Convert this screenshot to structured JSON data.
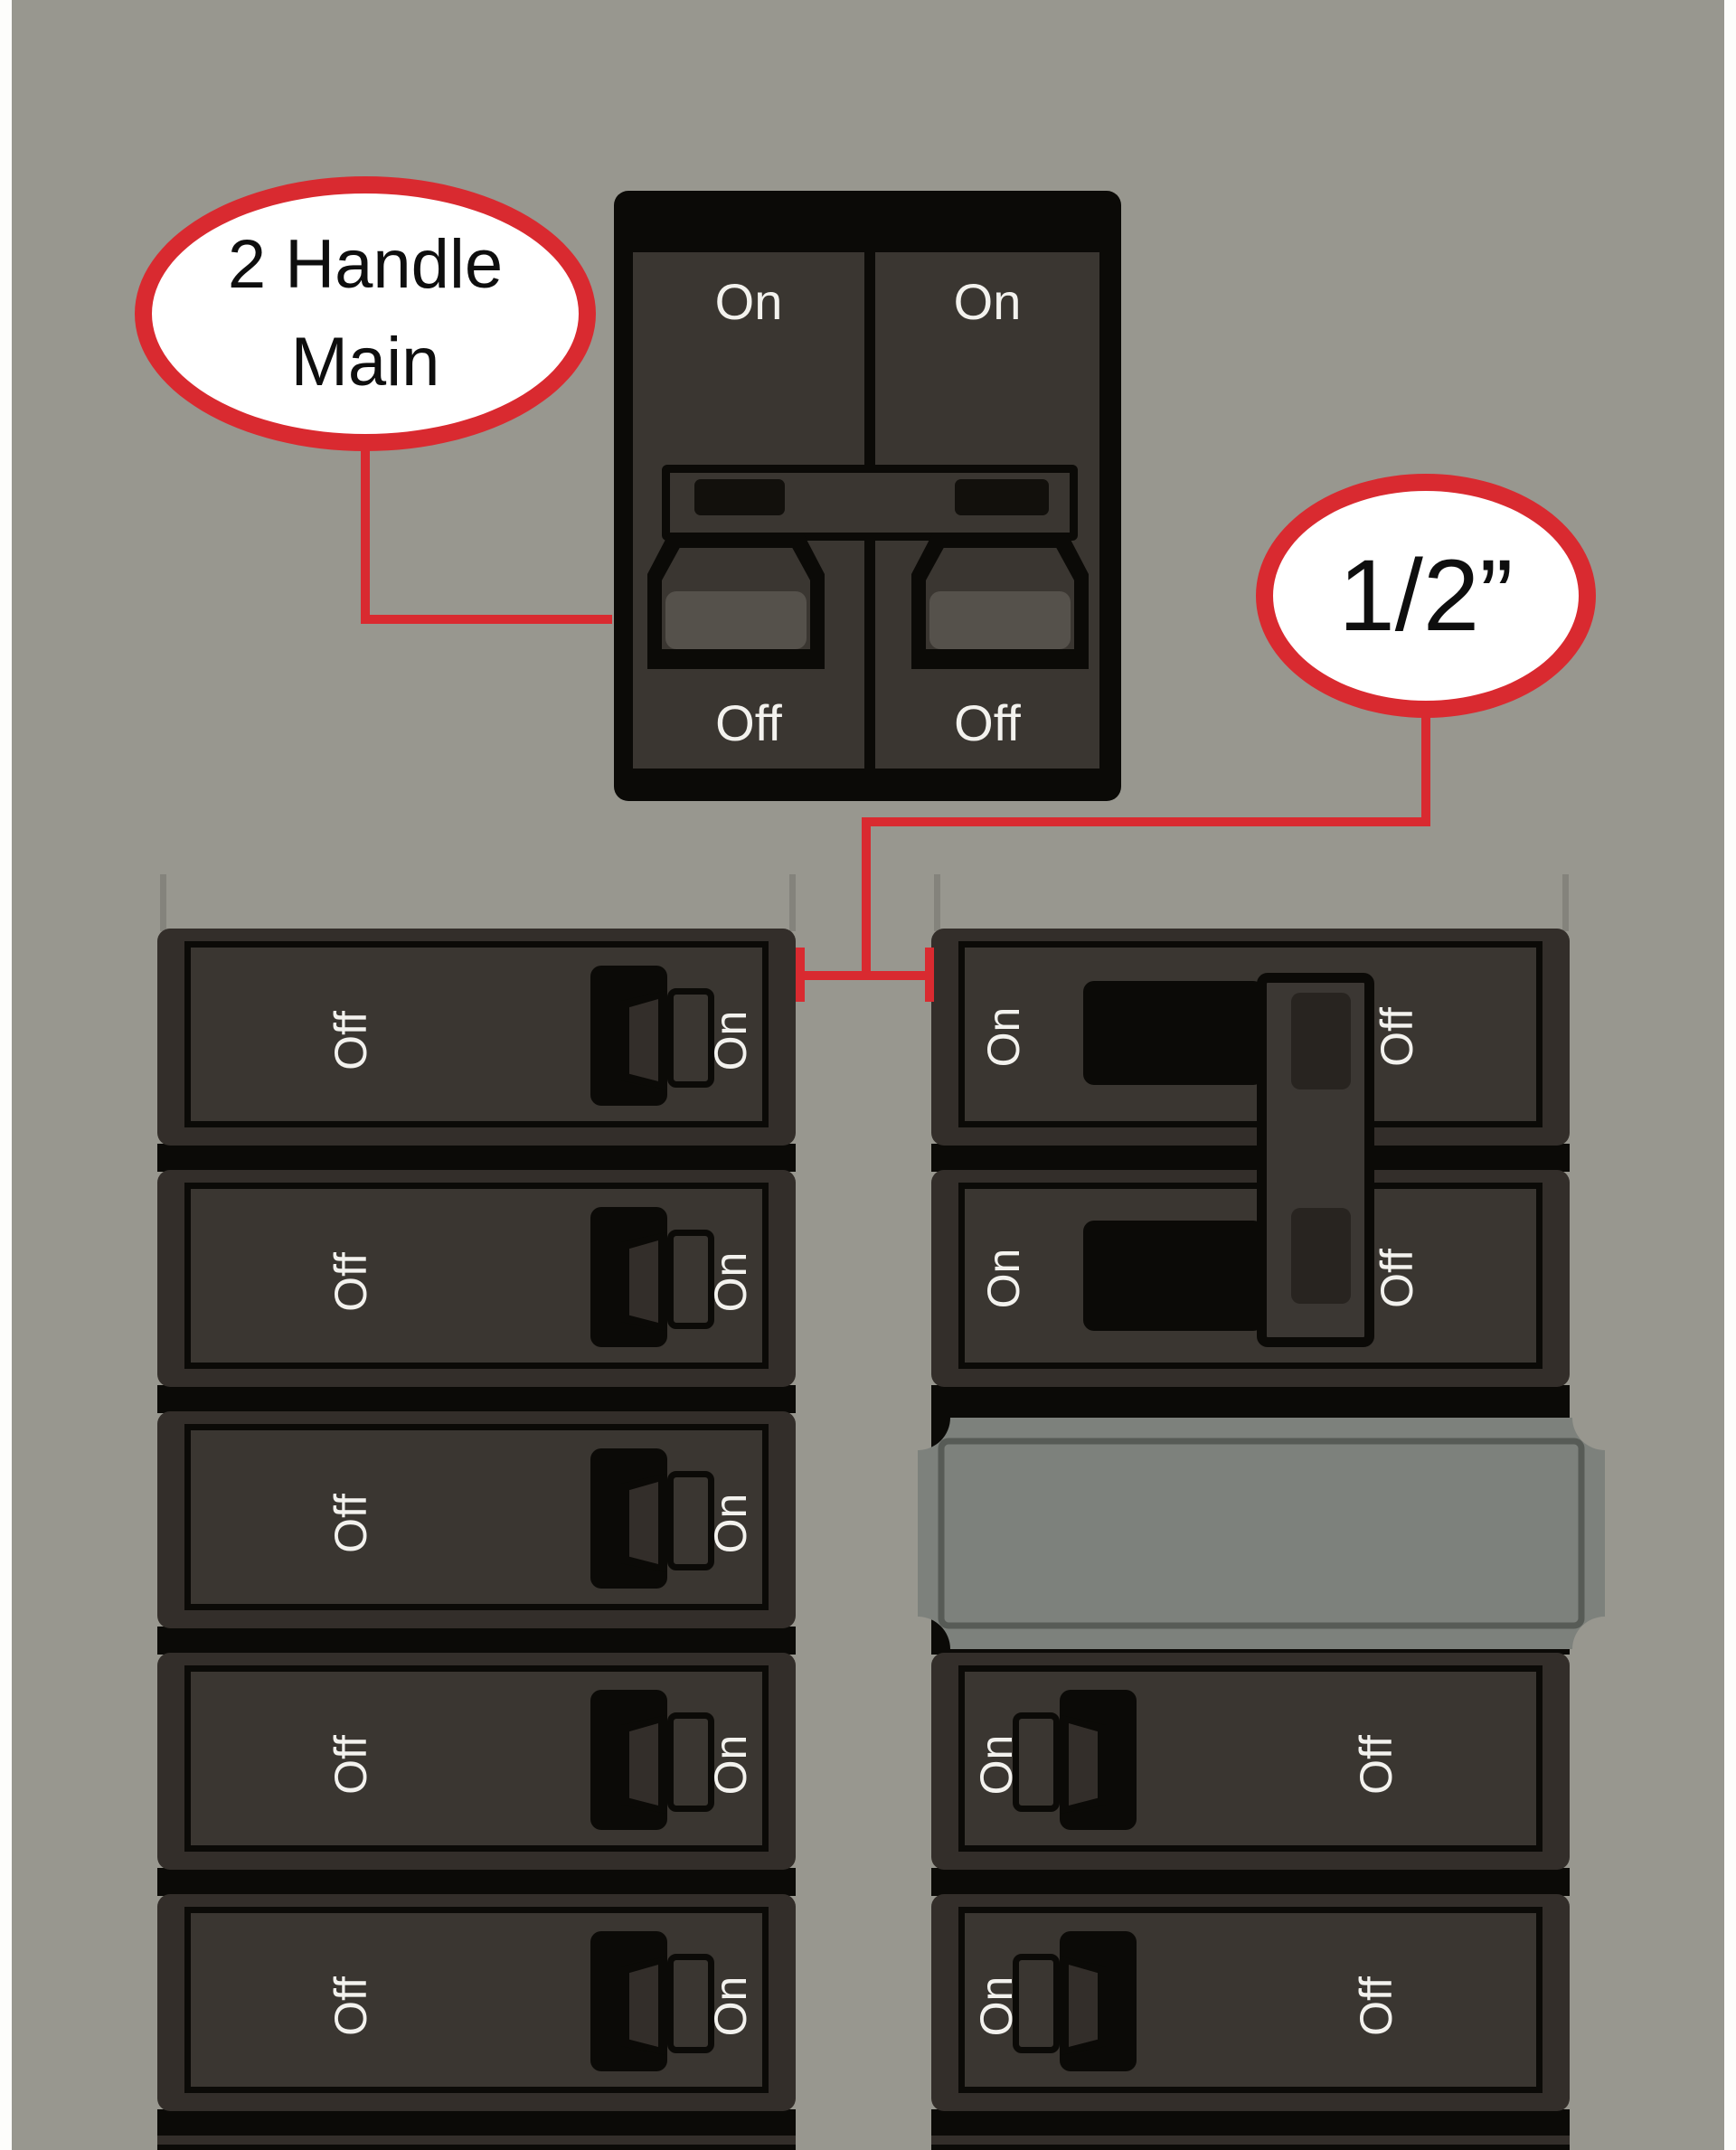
{
  "scene": {
    "background_color": "#98978f",
    "accent_red": "#d92a30",
    "breaker_body_color": "#332e2a",
    "breaker_face_color": "#3a3631",
    "label_color": "#f3f2ee",
    "filler_plate_color": "#7d817c",
    "black": "#0b0a07"
  },
  "callouts": {
    "two_handle_main": {
      "line1": "2 Handle",
      "line2": "Main"
    },
    "half_inch": {
      "text": "1/2”"
    }
  },
  "main_breaker": {
    "left_pole": {
      "top_label": "On",
      "bottom_label": "Off"
    },
    "right_pole": {
      "top_label": "On",
      "bottom_label": "Off"
    }
  },
  "left_column": {
    "rows": [
      {
        "left_label": "Off",
        "right_label": "On",
        "handle": "points right"
      },
      {
        "left_label": "Off",
        "right_label": "On",
        "handle": "points right"
      },
      {
        "left_label": "Off",
        "right_label": "On",
        "handle": "points right"
      },
      {
        "left_label": "Off",
        "right_label": "On",
        "handle": "points right"
      },
      {
        "left_label": "Off",
        "right_label": "On",
        "handle": "points right"
      }
    ]
  },
  "right_column": {
    "rows": [
      {
        "left_label": "On",
        "right_label": "Off",
        "handle": "tied 2-pole"
      },
      {
        "left_label": "On",
        "right_label": "Off",
        "handle": "tied 2-pole"
      },
      {
        "type": "blank filler plate"
      },
      {
        "left_label": "On",
        "right_label": "Off",
        "handle": "points left"
      },
      {
        "left_label": "On",
        "right_label": "Off",
        "handle": "points left"
      }
    ]
  }
}
